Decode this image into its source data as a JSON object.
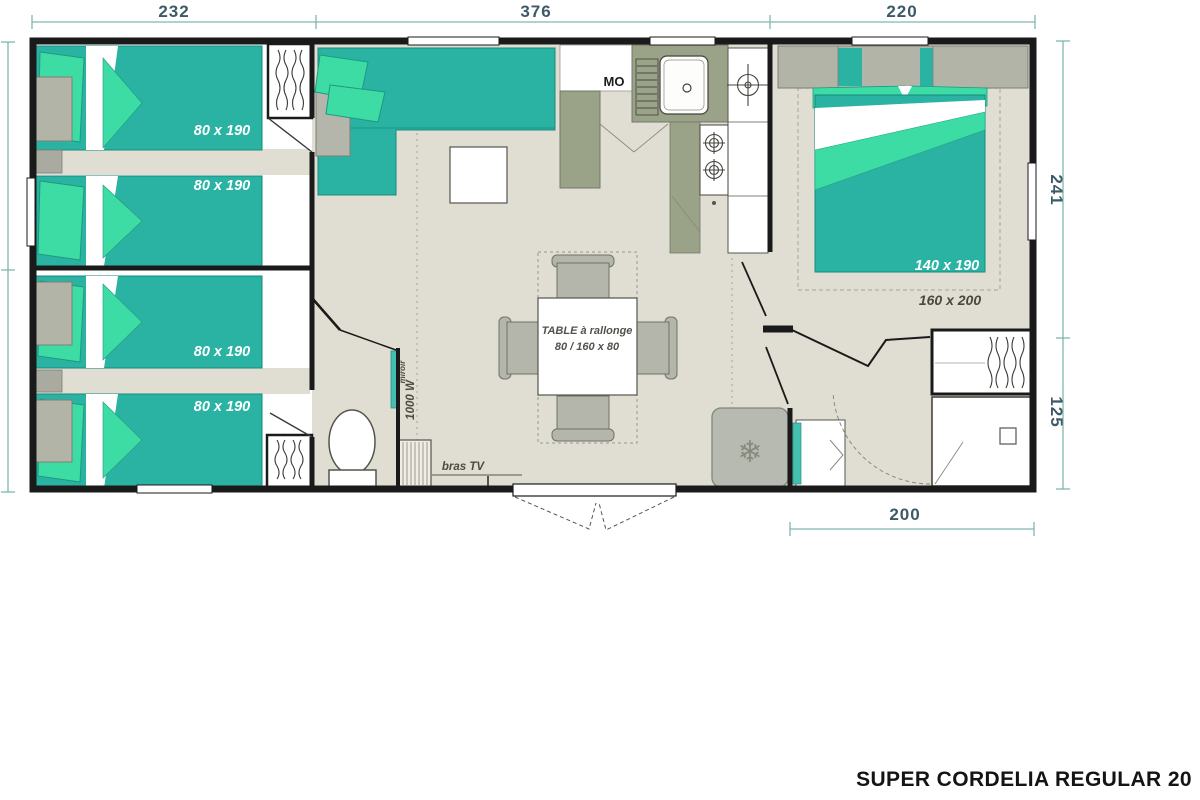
{
  "title": "SUPER CORDELIA REGULAR 20",
  "dimensions": {
    "top_left": "232",
    "top_middle": "376",
    "top_right": "220",
    "right_upper": "241",
    "right_lower": "125",
    "bottom": "200"
  },
  "bed_labels": {
    "singles": [
      "80 x 190",
      "80 x 190",
      "80 x 190",
      "80 x 190"
    ],
    "double": "140 x 190",
    "double_option": "160 x 200"
  },
  "labels": {
    "table_line1": "TABLE à rallonge",
    "table_line2": "80 / 160 x 80",
    "microwave": "MO",
    "tv_bracket": "bras TV",
    "heater": "1000 W",
    "mirror": "miroir"
  },
  "icons": {
    "snowflake": "❄"
  },
  "colors": {
    "bed_teal": "#2ab3a3",
    "pillow_green": "#3cdca4",
    "cabinet_olive": "#9aa287",
    "furniture_gray": "#b2b4a8",
    "floor_beige": "#e0ded2",
    "wall_black": "#1a1a1a",
    "dimension_teal": "#7fb6b0",
    "dimension_text": "#3d5a66"
  }
}
